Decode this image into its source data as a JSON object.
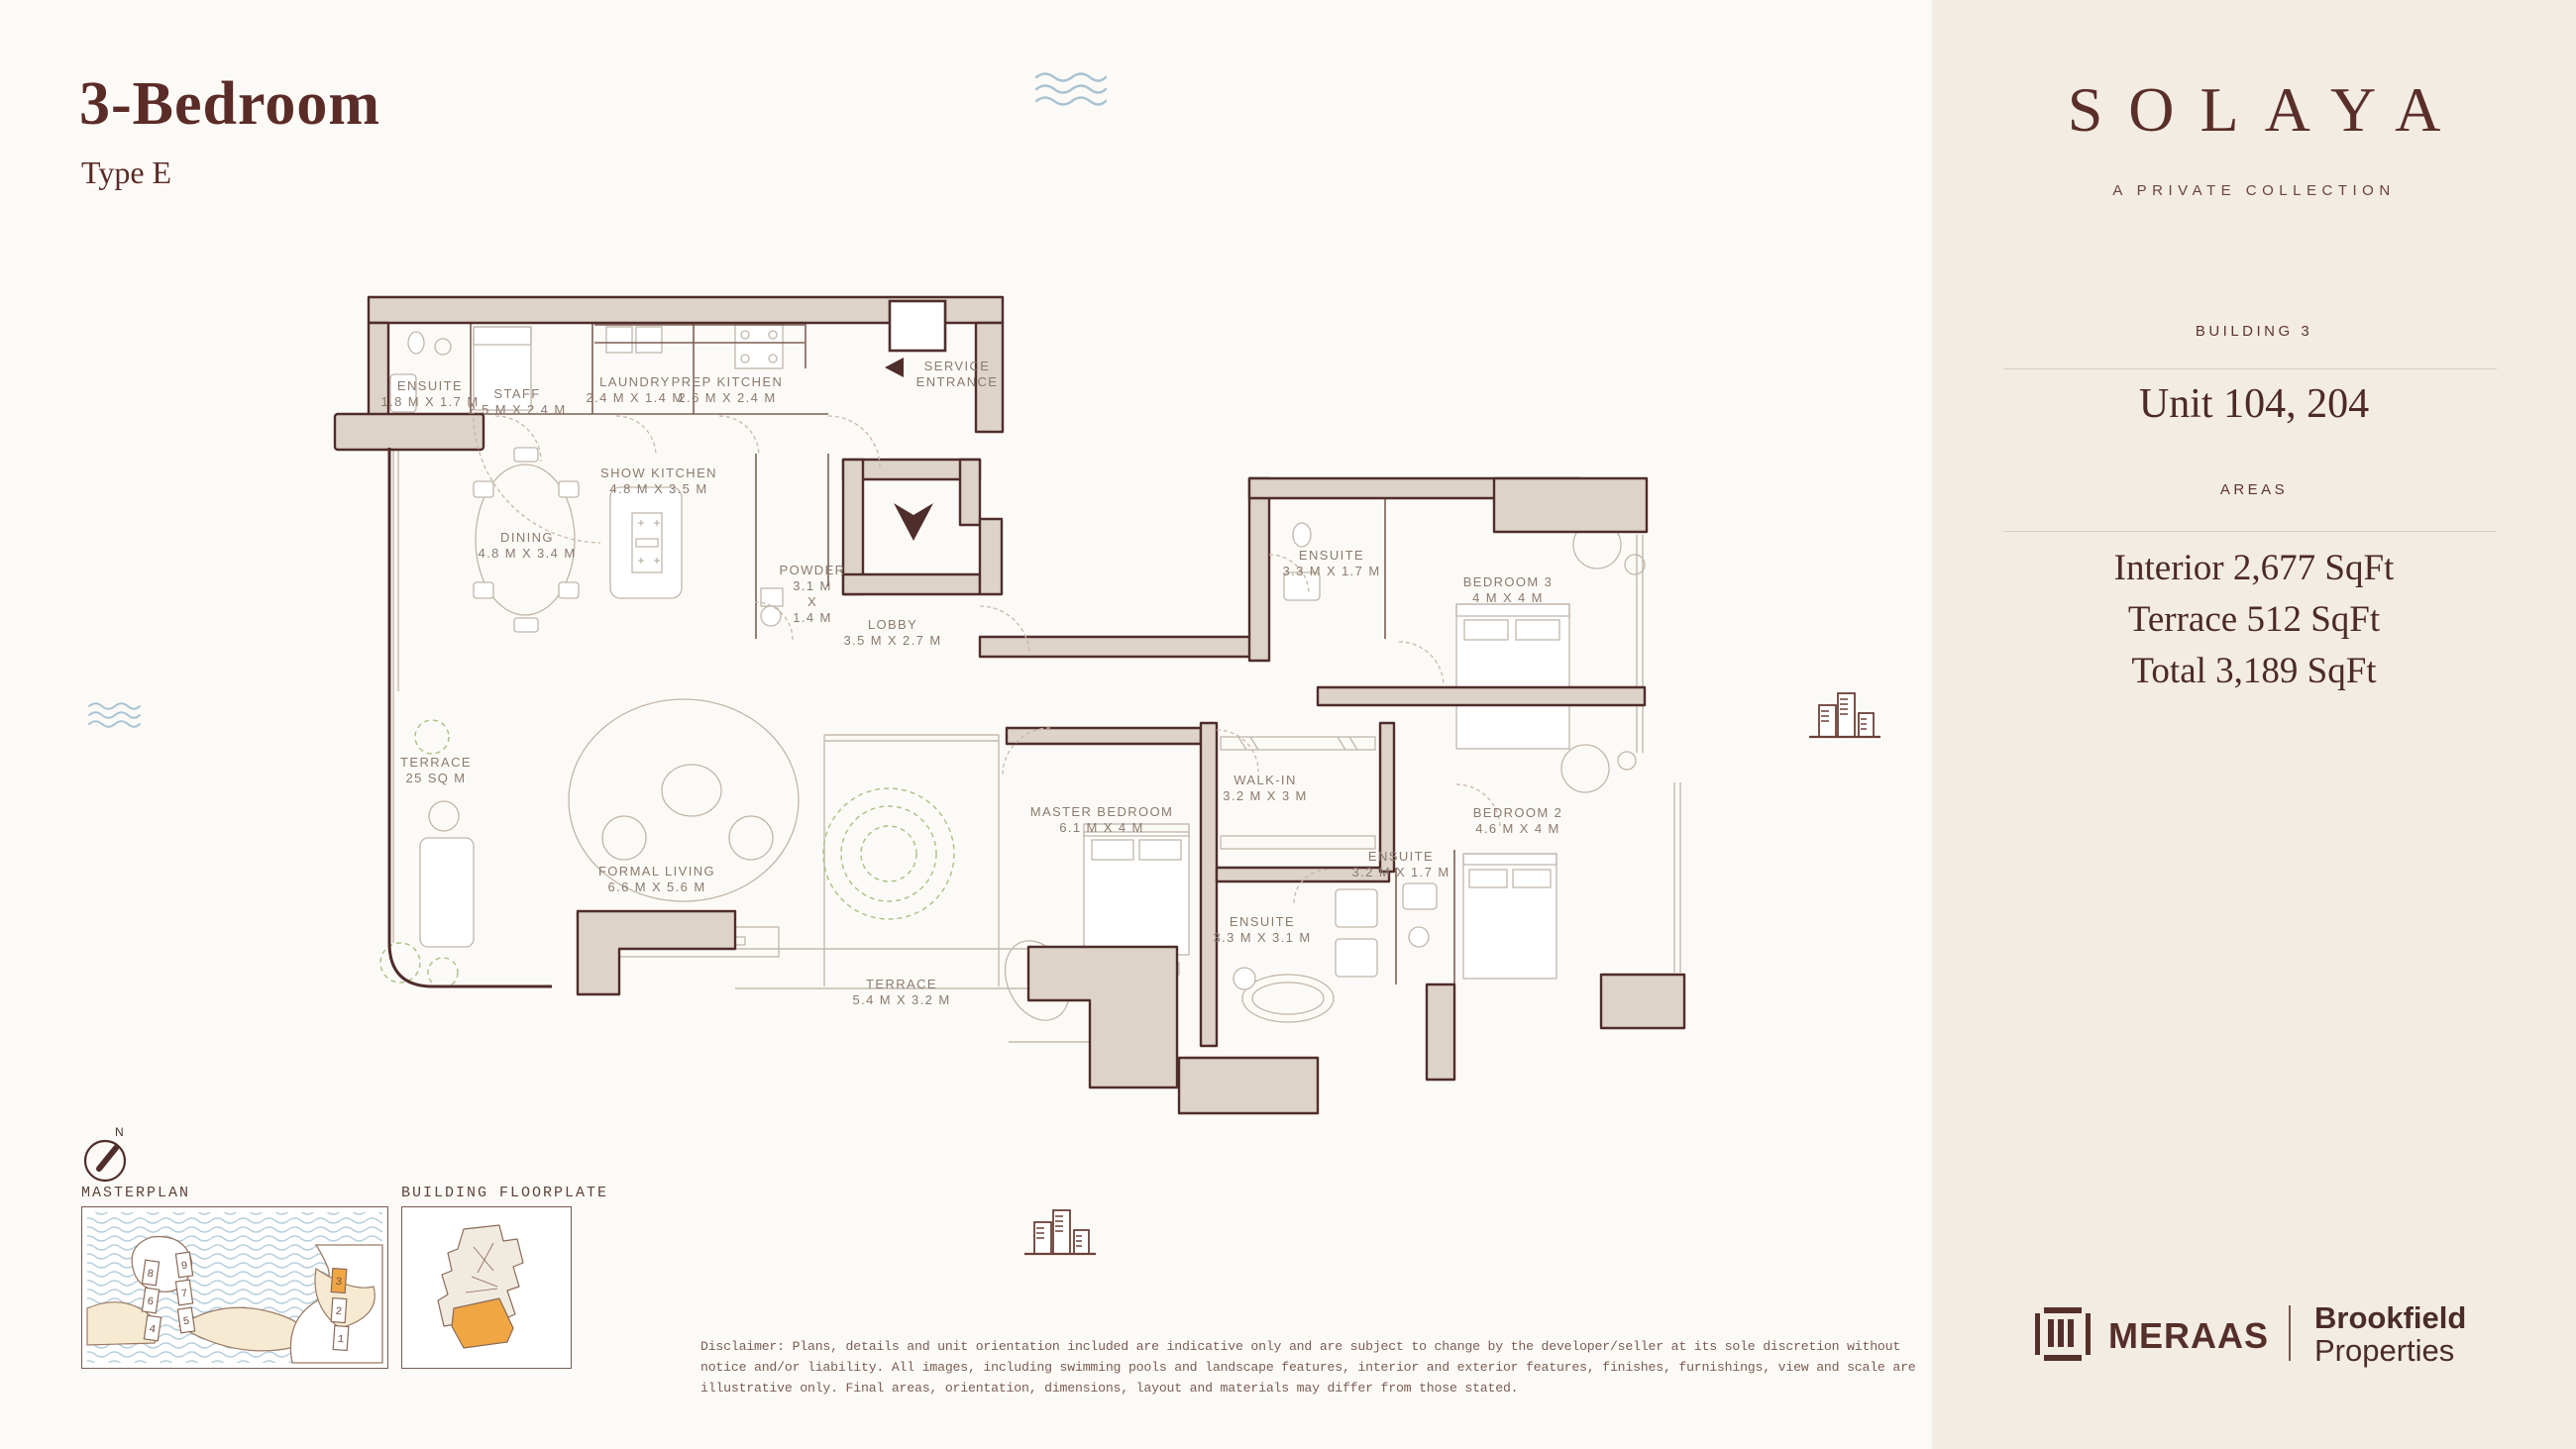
{
  "header": {
    "title": "3-Bedroom",
    "subtitle": "Type E"
  },
  "brand": {
    "wordmark": "SOLAYA",
    "tagline": "A PRIVATE COLLECTION"
  },
  "sidebar": {
    "building_label": "BUILDING 3",
    "unit": "Unit 104, 204",
    "areas_label": "AREAS",
    "area_interior": "Interior 2,677 SqFt",
    "area_terrace": "Terrace 512 SqFt",
    "area_total": "Total 3,189 SqFt"
  },
  "logos": {
    "meraas": "MERAAS",
    "brookfield_line1": "Brookfield",
    "brookfield_line2": "Properties"
  },
  "plan": {
    "rooms": [
      {
        "name": "ENSUITE",
        "dims": "1.8 M X 1.7 M"
      },
      {
        "name": "STAFF",
        "dims": "2.5 M X 2.4 M"
      },
      {
        "name": "LAUNDRY",
        "dims": "2.4 M X 1.4 M"
      },
      {
        "name": "PREP KITCHEN",
        "dims": "2.6 M X 2.4 M"
      },
      {
        "name": "SERVICE\nENTRANCE",
        "dims": ""
      },
      {
        "name": "SHOW KITCHEN",
        "dims": "4.8 M X 3.5 M"
      },
      {
        "name": "DINING",
        "dims": "4.8 M X 3.4 M"
      },
      {
        "name": "POWDER",
        "dims": "3.1 M\nX\n1.4 M"
      },
      {
        "name": "LOBBY",
        "dims": "3.5 M X 2.7 M"
      },
      {
        "name": "TERRACE",
        "dims": "25 SQ M"
      },
      {
        "name": "FORMAL LIVING",
        "dims": "6.6 M X 5.6 M"
      },
      {
        "name": "TERRACE",
        "dims": "5.4 M X 3.2 M"
      },
      {
        "name": "MASTER BEDROOM",
        "dims": "6.1 M X 4 M"
      },
      {
        "name": "WALK-IN",
        "dims": "3.2 M X 3 M"
      },
      {
        "name": "ENSUITE",
        "dims": "3.3 M X 1.7 M"
      },
      {
        "name": "BEDROOM 3",
        "dims": "4 M X 4 M"
      },
      {
        "name": "ENSUITE",
        "dims": "3.2 M X 1.7 M"
      },
      {
        "name": "ENSUITE",
        "dims": "3.3 M X 3.1 M"
      },
      {
        "name": "BEDROOM 2",
        "dims": "4.6 M X 4 M"
      }
    ]
  },
  "thumbs": {
    "compass": "N",
    "masterplan": {
      "label": "MASTERPLAN",
      "buildings": [
        "8",
        "6",
        "4",
        "9",
        "7",
        "5",
        "3",
        "2",
        "1"
      ],
      "highlighted_building": "3"
    },
    "floorplate": {
      "label": "BUILDING FLOORPLATE"
    }
  },
  "footer": {
    "disclaimer": "Disclaimer: Plans, details and unit orientation included are indicative only and are subject to change by the developer/seller at its sole discretion without notice and/or liability. All images, including swimming pools and landscape features, interior and exterior features, finishes, furnishings, view and scale are illustrative only. Final areas, orientation, dimensions, layout and materials may differ from those stated."
  },
  "colors": {
    "accent_maroon": "#5a2e29",
    "wall_fill": "#ddd3c9",
    "highlight_orange": "#f0a643",
    "water_blue": "#b6cfdc",
    "plant_green": "#a9c186",
    "sidebar_bg": "#f3ece3"
  }
}
